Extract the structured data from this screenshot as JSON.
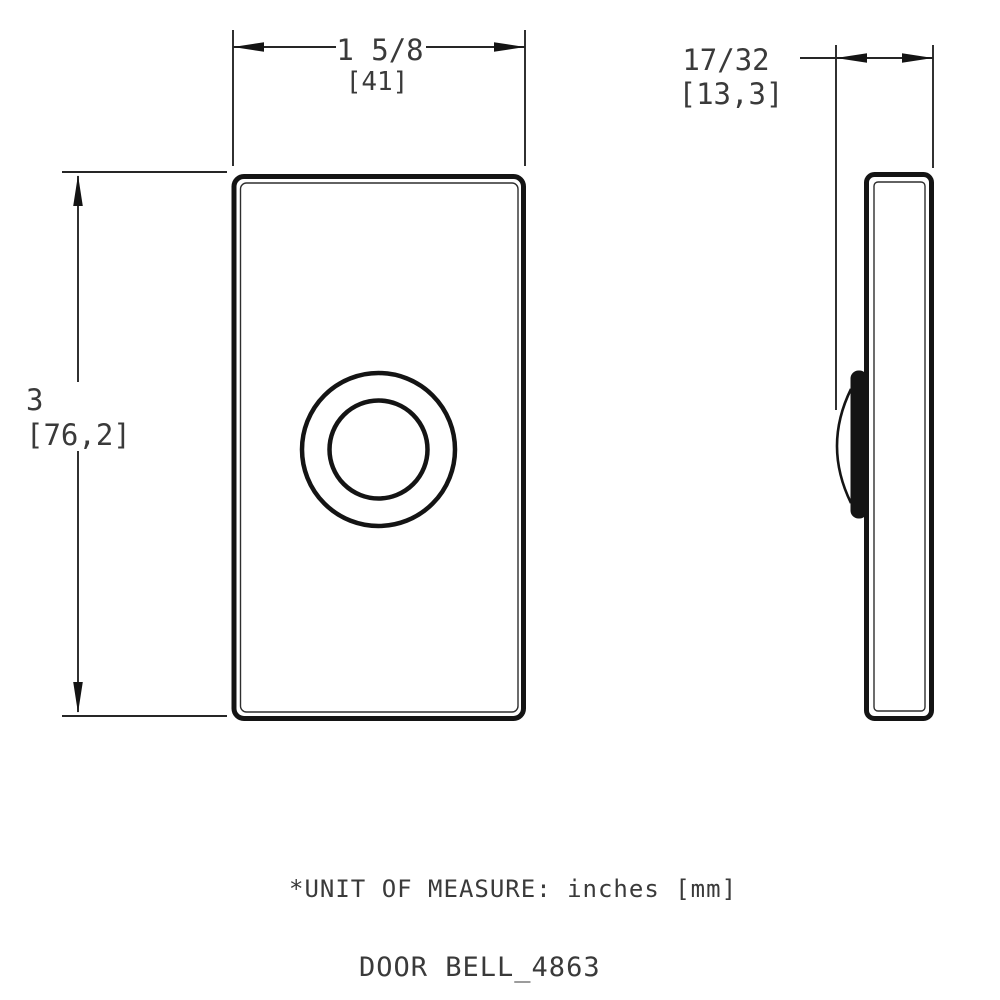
{
  "page": {
    "background_color": "#ffffff",
    "line_color": "#141414"
  },
  "views": {
    "front": {
      "label": "front-view",
      "width_dim": {
        "value": "1 5/8",
        "mm": "[41]"
      },
      "height_dim": {
        "value": "3",
        "mm": "[76,2]"
      }
    },
    "side": {
      "label": "side-view",
      "depth_dim": {
        "value": "17/32",
        "mm": "[13,3]"
      }
    }
  },
  "notes": {
    "unit_note": "*UNIT OF MEASURE: inches [mm]",
    "title": "DOOR BELL_4863"
  }
}
